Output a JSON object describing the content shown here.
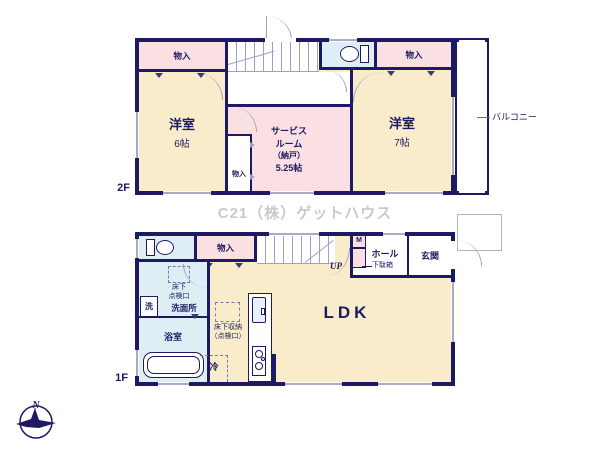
{
  "watermark": "C21（株）ゲットハウス",
  "compass": {
    "north": "N"
  },
  "colors": {
    "wall": "#1d1a63",
    "room_cream": "#f8ecca",
    "room_pink": "#fadfe3",
    "room_blue": "#ddeef5",
    "outline_light": "#9aa0c8"
  },
  "floor2": {
    "floor_label": "2F",
    "closet_left": "物入",
    "closet_right": "物入",
    "closet_small": "物入",
    "stairs": "DN",
    "bedroom_west_name": "洋室",
    "bedroom_west_size": "6帖",
    "bedroom_east_name": "洋室",
    "bedroom_east_size": "7帖",
    "service_room_line1": "サービス",
    "service_room_line2": "ルーム",
    "service_room_line3": "（納戸）",
    "service_room_line4": "5.25帖",
    "balcony": "バルコニー"
  },
  "floor1": {
    "floor_label": "1F",
    "closet": "物入",
    "stairs": "UP",
    "meter": "M",
    "hall": "ホール",
    "shoe_cabinet": "下駄箱",
    "entrance": "玄関",
    "washer": "洗",
    "washroom": "洗面所",
    "hatch_line1": "床下",
    "hatch_line2": "点検口",
    "bathroom": "浴室",
    "living": "LDK",
    "fridge": "冷",
    "storage_line1": "床下収納",
    "storage_line2": "（点検口）"
  }
}
